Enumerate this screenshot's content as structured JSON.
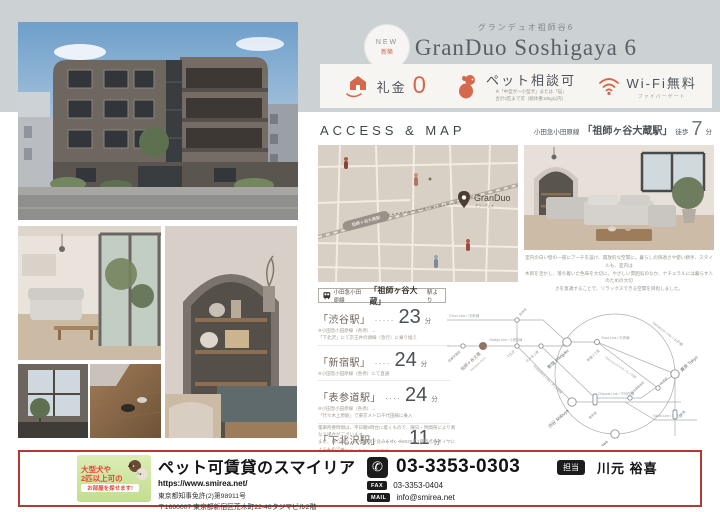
{
  "colors": {
    "accent": "#d4694e",
    "band": "#ccd1d4",
    "map_bg": "#d9d0c5",
    "footer_border": "#b33a32"
  },
  "header": {
    "badge1": "NEW",
    "badge2": "新築",
    "subtitle": "グランデュオ祖師谷6",
    "title": "GranDuo Soshigaya 6"
  },
  "features": {
    "f1": {
      "label": "礼金",
      "value": "0"
    },
    "f2": {
      "label": "ペット相談可",
      "note1": "※「中型犬〜小型犬」または「猫」",
      "note2": "合計2匹まで可（総体重18kg以内）"
    },
    "f3": {
      "label": "Wi-Fi無料",
      "note": "ファイバーゲート"
    }
  },
  "access": {
    "heading": "ACCESS & MAP",
    "line": "小田急小田原線",
    "station": "「祖師ヶ谷大蔵駅」",
    "walk_prefix": "徒歩",
    "walk_min": "7",
    "walk_unit": "分"
  },
  "map": {
    "station": "祖師ヶ谷大蔵駅",
    "pin": "GranDuo",
    "pin_sub": "グランデュオ"
  },
  "caption": {
    "l1": "室内の白い壁の一部にアーチを設け、開放的な空間に。暮らしの快適さや使い勝手、スタイルも、室内は",
    "l2": "木目を活かし、落ち着いた色味を大切に。やさしい雰囲気のなか、ナチュラルには暮らす人のための大切",
    "l3": "さを意識することで、リラックスできる空間を目指しました。"
  },
  "st": {
    "header": {
      "line": "小田急小田原線",
      "station": "「祖師ヶ谷大蔵」",
      "suffix": "駅より"
    },
    "rows": [
      {
        "name": "「渋谷駅」",
        "dots": "·····",
        "min": "23",
        "unit": "分",
        "note1": "※小田急小田原線（各停）→",
        "note2": "「下北沢」にて京王井の頭線（急行）に乗り換え"
      },
      {
        "name": "「新宿駅」",
        "dots": "····",
        "min": "24",
        "unit": "分",
        "note1": "※小田急小田原線（各停）にて直通",
        "note2": ""
      },
      {
        "name": "「表参道駅」",
        "dots": "····",
        "min": "24",
        "unit": "分",
        "note1": "※小田急小田原線（各停）→",
        "note2": "「代々木上原駅」で東京メトロ千代田線に乗入"
      },
      {
        "name": "「下北沢駅」",
        "dots": "·····",
        "min": "11",
        "unit": "分",
        "note1": "※小田急小田原線（各停）にて直通",
        "note2": ""
      }
    ],
    "disc": {
      "l1": "電車所要時間は、平日朝8時台に着くもので、曜日・時間帯により異なる場合がございます。",
      "l2": "また、乗り換え・待ち時間を含みます。※2025年1月時点のダイヤによるものです。",
      "l3": "（Yahoo!路線にて調べ）"
    }
  },
  "rail": {
    "lines": {
      "chuo": "Chuo Line / 中央線",
      "chuo2": "Chuo Line / 中央線",
      "odakyu": "Odakyu Line / 小田急線",
      "inokashira": "Inokashira Line / 井の頭線",
      "chiyoda": "Chiyoda Line / 千代田線",
      "marunouchi": "Marunouchi Line / 丸ノ内線",
      "ginza": "Ginza Line / 銀座線",
      "yamanote": "Yamanote Line / 山手線"
    },
    "st": {
      "seijo": "成城学園前",
      "soshigaya": "祖師ヶ谷大蔵",
      "soshigaya_en": "Soshigaya-Okura",
      "kichijoji": "吉祥寺",
      "shimokitazawa": "下北沢",
      "yoyogiuehara": "代々木上原",
      "shinjuku": "新宿 Shinjuku",
      "shinjuku3": "新宿三丁目",
      "kokkai": "国会議事堂前",
      "shibuya": "渋谷 Shibuya",
      "omotesando": "表参道",
      "otemachi": "大手町",
      "tokyo": "東京 Tokyo",
      "shimbashi": "新橋",
      "shinagawa": "品川 Shinagawa"
    }
  },
  "footer": {
    "banner": {
      "l1": "大型犬や",
      "l2": "2匹以上可の",
      "l3": "お部屋を探せます!"
    },
    "company": "ペット可賃貸のスマイリア",
    "url": "https://www.smirea.net/",
    "license": "東京都知事免許(2)第98911号",
    "address": "〒1600007 東京都新宿区荒木町22-48タジマビル2階",
    "tel": "03-3353-0303",
    "fax_label": "FAX",
    "fax": "03-3353-0404",
    "mail_label": "MAIL",
    "mail": "info@smirea.net",
    "staff_label": "担当",
    "staff": "川元 裕喜"
  }
}
